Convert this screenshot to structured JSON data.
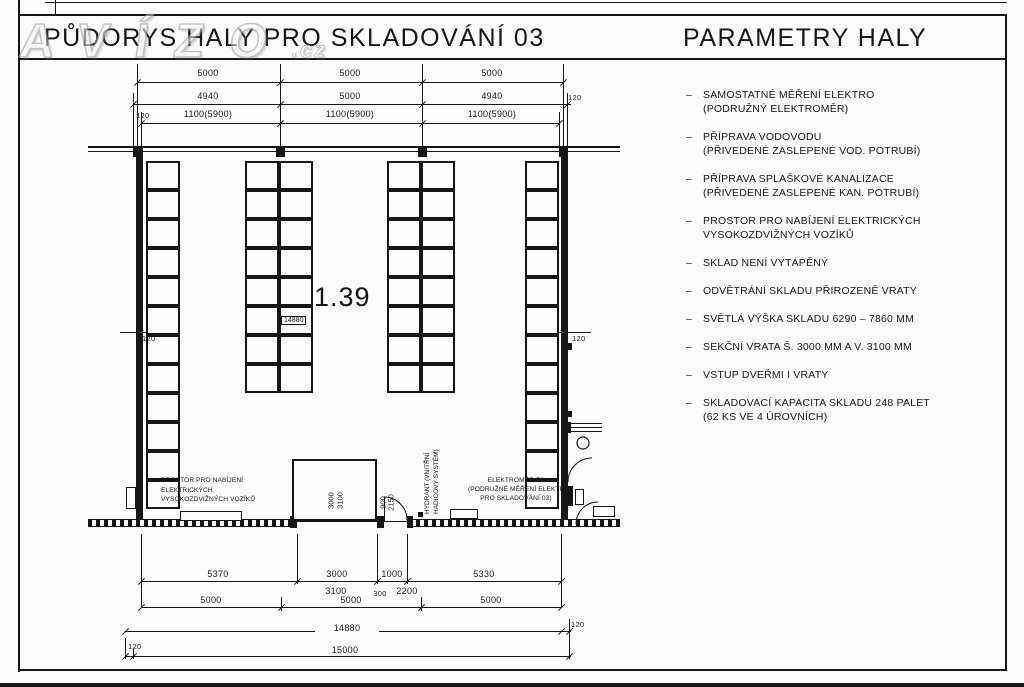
{
  "ui": {
    "dash": "–"
  },
  "watermark": {
    "main": "AVÍZO",
    "ext": ".cz"
  },
  "header": {
    "left_title": "PŮDORYS HALY PRO SKLADOVÁNÍ 03",
    "right_title": "PARAMETRY HALY"
  },
  "parameters": [
    {
      "line1": "SAMOSTATNÉ MĚŘENÍ ELEKTRO",
      "line2": "(PODRUŽNÝ ELEKTROMĚR)"
    },
    {
      "line1": "PŘÍPRAVA VODOVODU",
      "line2": "(PŘIVEDENÉ ZASLEPENÉ VOD. POTRUBÍ)"
    },
    {
      "line1": "PŘÍPRAVA SPLAŠKOVÉ KANALIZACE",
      "line2": "(PŘIVEDENÉ ZASLEPENÉ KAN. POTRUBÍ)"
    },
    {
      "line1": "PROSTOR PRO NABÍJENÍ ELEKTRICKÝCH",
      "line2": "VYSOKOZDVIŽNÝCH VOZÍKŮ"
    },
    {
      "line1": "SKLAD NENÍ VYTÁPĚNÝ"
    },
    {
      "line1": "ODVĚTRÁNÍ SKLADU PŘIROZENĚ VRATY"
    },
    {
      "line1": "SVĚTLÁ VÝŠKA SKLADU 6290 – 7860 MM"
    },
    {
      "line1": "SEKČNÍ VRATA Š. 3000 MM A V. 3100 MM"
    },
    {
      "line1": "VSTUP DVEŘMI I VRATY"
    },
    {
      "line1": "SKLADOVACÍ KAPACITA SKLADU 248 PALET",
      "line2": "(62 KS VE 4 ÚROVNÍCH)"
    }
  ],
  "dims": {
    "top_row1": [
      "5000",
      "5000",
      "5000"
    ],
    "top_row2": [
      "4940",
      "5000",
      "4940"
    ],
    "top_row3": [
      "1100(5900)",
      "1100(5900)",
      "1100(5900)"
    ],
    "top_left_wall": "120",
    "top_right_wall": "120",
    "mid_left_wall": "120",
    "mid_right_wall": "120",
    "bottom_row1": [
      "5370",
      "3000",
      "1000",
      "5330"
    ],
    "bottom_row1_sub": [
      "3100",
      "300",
      "2200"
    ],
    "bottom_row2": [
      "5000",
      "5000",
      "5000"
    ],
    "bottom_total_inner": "14880",
    "bottom_inner_wall": "120",
    "bottom_total": "15000",
    "bottom_outer_wall": "120"
  },
  "plan": {
    "room_number": "1.39",
    "room_dim_label": "14880",
    "gate_width": "3000",
    "gate_height": "3100",
    "door_width": "900",
    "door_height": "2150",
    "charging_label": [
      "PROSTOR PRO NABÍJENÍ",
      "ELEKTRICKÝCH",
      "VYSOKOZDVIŽNÝCH VOZÍKŮ"
    ],
    "hydrant_label": [
      "HYDRANT (VNITŘNÍ",
      "HADICOVÝ SYSTÉM)"
    ],
    "meter_label": [
      "ELEKTROMĚR E8",
      "(PODRUŽNÉ MĚŘENÍ ELEKTRO",
      "PRO SKLADOVÁNÍ 03)"
    ]
  }
}
